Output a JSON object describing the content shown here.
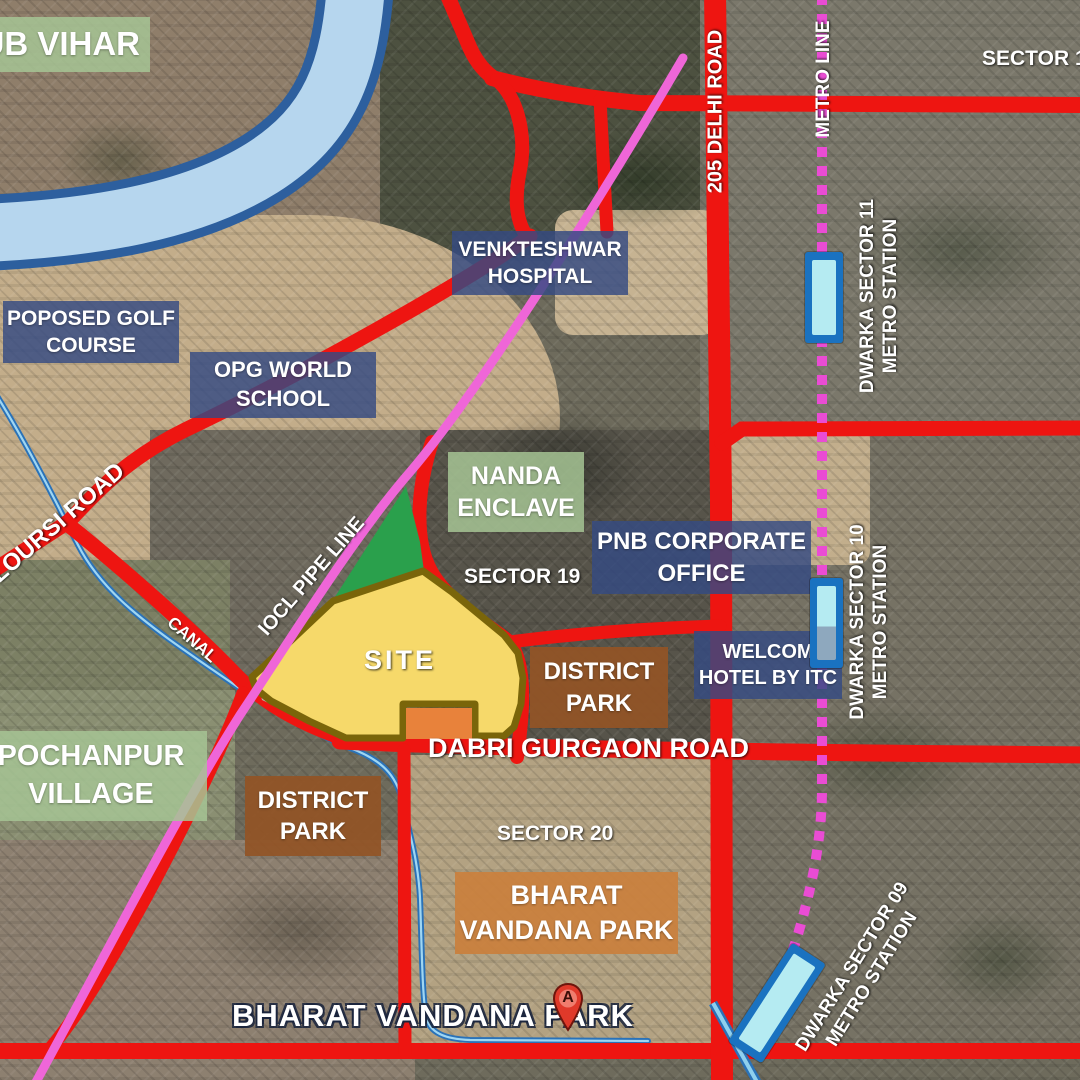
{
  "places": {
    "ub_vihar": {
      "name": "UB VIHAR"
    },
    "golf": {
      "line1": "POPOSED GOLF",
      "line2": "COURSE"
    },
    "opg": {
      "line1": "OPG WORLD",
      "line2": "SCHOOL"
    },
    "hospital": {
      "line1": "VENKTESHWAR",
      "line2": "HOSPITAL"
    },
    "nanda": {
      "line1": "NANDA",
      "line2": "ENCLAVE"
    },
    "pnb": {
      "line1": "PNB CORPORATE",
      "line2": "OFFICE"
    },
    "welcom": {
      "line1": "WELCOM",
      "line2": "HOTEL BY ITC"
    },
    "district_park_east": {
      "line1": "DISTRICT",
      "line2": "PARK"
    },
    "district_park_west": {
      "line1": "DISTRICT",
      "line2": "PARK"
    },
    "bharat_park_box": {
      "line1": "BHARAT",
      "line2": "VANDANA PARK"
    },
    "pochanpur": {
      "line1": "POCHANPUR",
      "line2": "VILLAGE"
    },
    "site": {
      "name": "SITE"
    },
    "bharat_park_map_label": {
      "name": "BHARAT VANDANA PARK"
    },
    "pin": {
      "letter": "A"
    }
  },
  "sectors": {
    "sector11": "SECTOR 11",
    "sector19": "SECTOR 19",
    "sector20": "SECTOR 20"
  },
  "roads": {
    "delhi": "205 DELHI ROAD",
    "dabri": "DABRI GURGAON ROAD",
    "loursi": "LOURSI ROAD"
  },
  "transit": {
    "metro_line": "METRO LINE",
    "stations": {
      "sector11": {
        "line1": "DWARKA SECTOR 11",
        "line2": "METRO STATION"
      },
      "sector10": {
        "line1": "DWARKA SECTOR 10",
        "line2": "METRO STATION"
      },
      "sector09": {
        "line1": "DWARKA SECTOR 09",
        "line2": "METRO STATION"
      }
    }
  },
  "waterways": {
    "canal": "CANAL"
  },
  "infrastructure": {
    "iocl": "IOCL PIPE LINE"
  },
  "colors": {
    "road_red": "#ee1511",
    "pipeline_pink": "#ef66d8",
    "metro_dotted_pink": "#ea4cd4",
    "site_fill": "#f6d96a",
    "site_border": "#7a650a",
    "site_inner_orange": "#e8823b",
    "green_buffer": "#2aa04c",
    "river_fill": "#b6d6ee",
    "river_border": "#2d5f9e",
    "canal_blue": "#2a72b8",
    "station_outer": "#1a72c0",
    "station_inner": "#b5ebf2",
    "label_blue": "#344a82",
    "label_green": "#a6c494",
    "label_brown": "#925426",
    "label_orange": "#c9813e"
  }
}
